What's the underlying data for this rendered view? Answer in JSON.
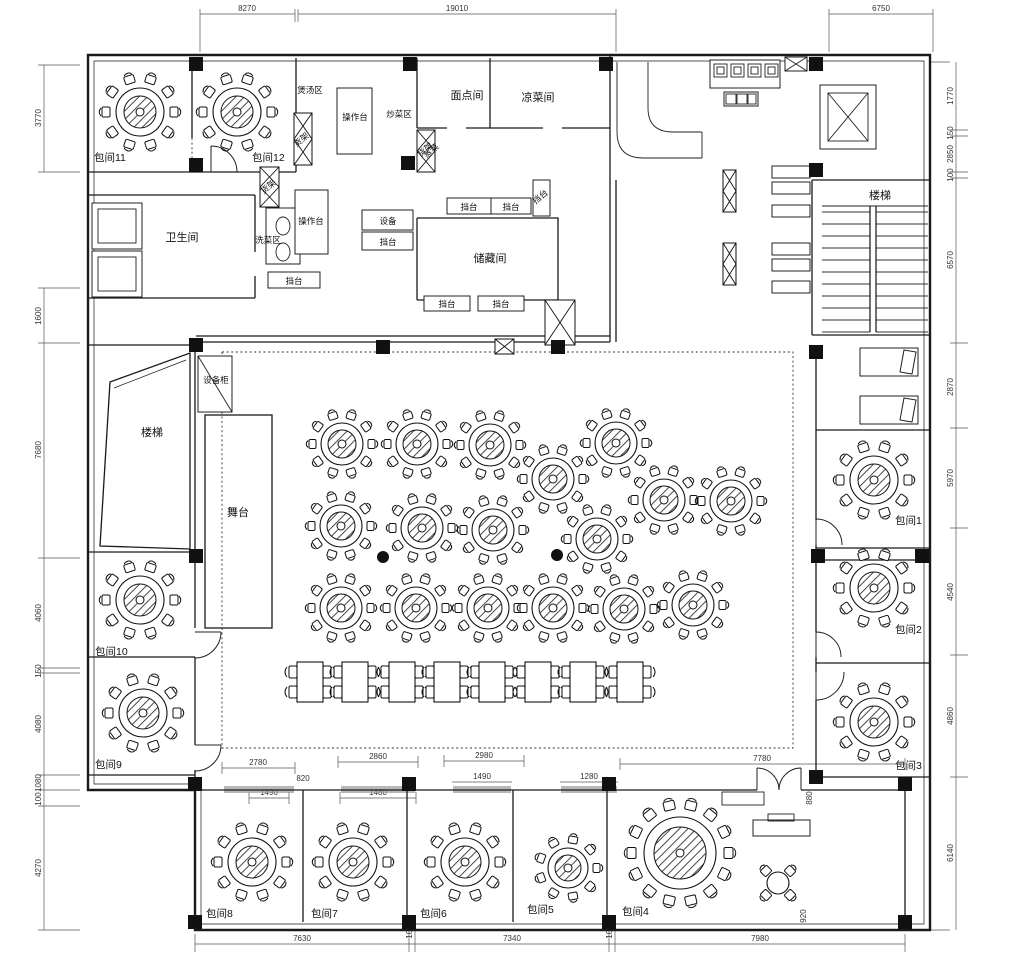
{
  "labels": {
    "private": [
      "包间1",
      "包间2",
      "包间3",
      "包间4",
      "包间5",
      "包间6",
      "包间7",
      "包间8",
      "包间9",
      "包间10",
      "包间11",
      "包间12"
    ],
    "restroom": "卫生间",
    "stairs": "楼梯",
    "stage": "舞台",
    "pastry_room": "面点间",
    "cold_dish_room": "凉菜间",
    "storage_room": "储藏间",
    "soup_area": "煲汤区",
    "work_counter": "操作台",
    "stir_fry_area": "炒菜区",
    "wash_area": "洗菜区",
    "steam_dish": "蒸菜",
    "shelf": "货架",
    "equipment": "设备",
    "equipment_cabinet": "设备柜",
    "serving_counter": "挡台"
  },
  "dims": {
    "top": [
      "8270",
      "19010",
      "6750"
    ],
    "bottom": [
      "7630",
      "100",
      "7340",
      "100",
      "7980"
    ],
    "left": [
      "3770",
      "1600",
      "7680",
      "4060",
      "150",
      "4080",
      "1080",
      "100",
      "4270"
    ],
    "right": [
      "1770",
      "150",
      "2850",
      "100",
      "6570",
      "2870",
      "5970",
      "4540",
      "4860",
      "6140"
    ],
    "inner": [
      "2780",
      "1490",
      "820",
      "2860",
      "1480",
      "2980",
      "1490",
      "1280",
      "7780",
      "880",
      "920"
    ]
  }
}
